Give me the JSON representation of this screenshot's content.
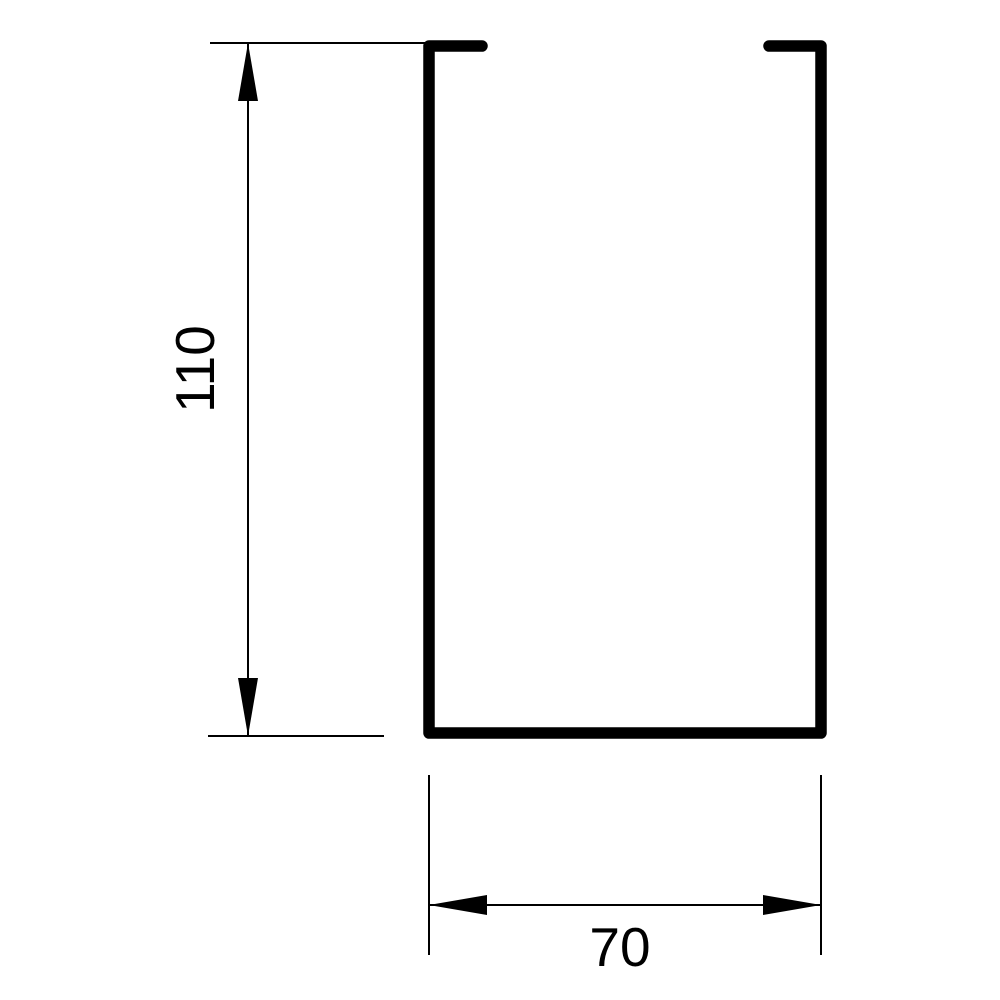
{
  "drawing": {
    "kind": "technical-cross-section",
    "subject": "u-channel-profile-with-inward-top-lips",
    "background_color": "#ffffff",
    "line_color": "#000000",
    "dimensions": {
      "height": {
        "label": "110",
        "value": 110,
        "orientation": "vertical"
      },
      "width": {
        "label": "70",
        "value": 70,
        "orientation": "horizontal"
      }
    }
  }
}
